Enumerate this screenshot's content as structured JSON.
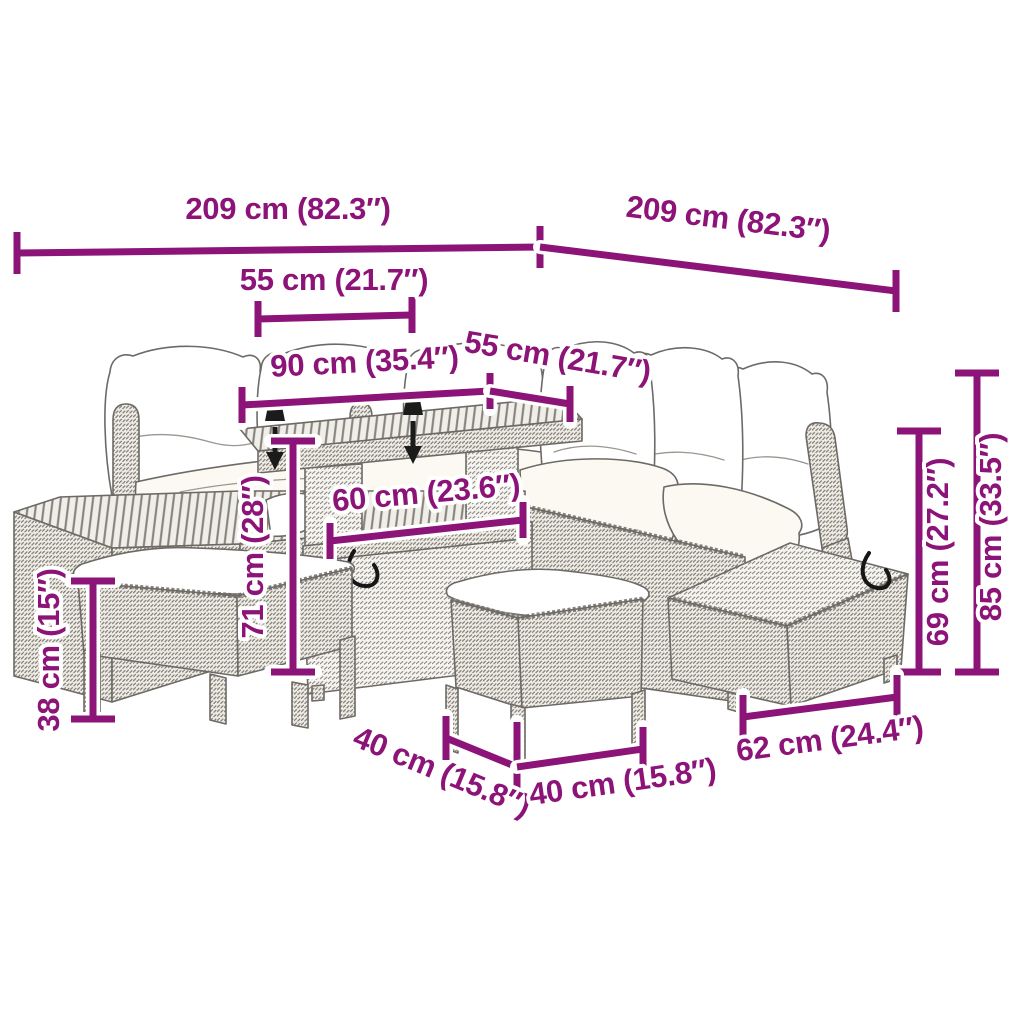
{
  "title": "Garden furniture set dimension diagram",
  "colors": {
    "dimension_annotation": "#8C1377",
    "line_art": "#6d6a66",
    "background": "#ffffff",
    "marker_black": "#1b1b1b"
  },
  "annotations": [
    {
      "id": "overall-width-left",
      "label": "209 cm (82.3″)"
    },
    {
      "id": "overall-depth-right",
      "label": "209 cm (82.3″)"
    },
    {
      "id": "seat-width",
      "label": "55 cm (21.7″)"
    },
    {
      "id": "table-length",
      "label": "90 cm (35.4″)"
    },
    {
      "id": "table-depth",
      "label": "55 cm (21.7″)"
    },
    {
      "id": "storage-width",
      "label": "60 cm (23.6″)"
    },
    {
      "id": "table-height",
      "label": "71 cm (28″)"
    },
    {
      "id": "stool-height",
      "label": "38 cm (15″)"
    },
    {
      "id": "seat-frame-height",
      "label": "69 cm (27.2″)"
    },
    {
      "id": "total-height",
      "label": "85 cm (33.5″)"
    },
    {
      "id": "ottoman-width",
      "label": "62 cm (24.4″)"
    },
    {
      "id": "stool-depth",
      "label": "40 cm (15.8″)"
    },
    {
      "id": "stool-width",
      "label": "40 cm (15.8″)"
    }
  ]
}
